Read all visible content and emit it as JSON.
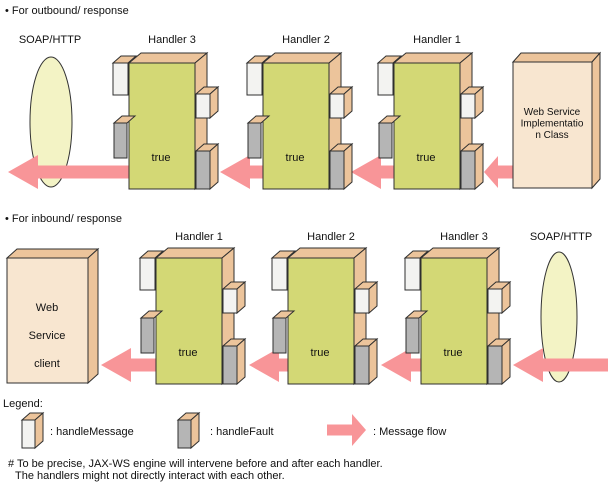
{
  "diagram_title": "JAX-WS handler chain message flow",
  "sections": [
    {
      "id": "outbound-response",
      "title": "• For outbound/ response",
      "soap_label": "SOAP/HTTP",
      "handlers": [
        {
          "label": "Handler 3",
          "true_label": "true"
        },
        {
          "label": "Handler 2",
          "true_label": "true"
        },
        {
          "label": "Handler 1",
          "true_label": "true"
        }
      ],
      "endpoint": {
        "lines": [
          "Web Service",
          "Implementatio",
          "n Class"
        ]
      }
    },
    {
      "id": "inbound-response",
      "title": "• For inbound/ response",
      "soap_label": "SOAP/HTTP",
      "handlers": [
        {
          "label": "Handler 1",
          "true_label": "true"
        },
        {
          "label": "Handler 2",
          "true_label": "true"
        },
        {
          "label": "Handler 3",
          "true_label": "true"
        }
      ],
      "endpoint": {
        "lines": [
          "Web",
          "Service",
          "client"
        ]
      }
    }
  ],
  "legend": {
    "title": "Legend:",
    "items": [
      {
        "icon": "handle-message-box-icon",
        "label": ": handleMessage"
      },
      {
        "icon": "handle-fault-box-icon",
        "label": ": handleFault"
      },
      {
        "icon": "message-flow-arrow-icon",
        "label": ": Message flow"
      }
    ]
  },
  "footnote": {
    "line1": "# To be precise, JAX-WS engine will intervene before and after each handler.",
    "line2": "The handlers might not directly interact with each other."
  },
  "colors": {
    "arrow_pink": "#f89598",
    "handler_front": "#d3d875",
    "box_depth_tan": "#ecc49b",
    "handle_message_white": "#f3f3f1",
    "handle_fault_gray": "#b5b5b5",
    "endpoint_front": "#f8e6d0",
    "soap_pipe_fill": "#f3f3c5",
    "outline": "#2f2f2f"
  }
}
